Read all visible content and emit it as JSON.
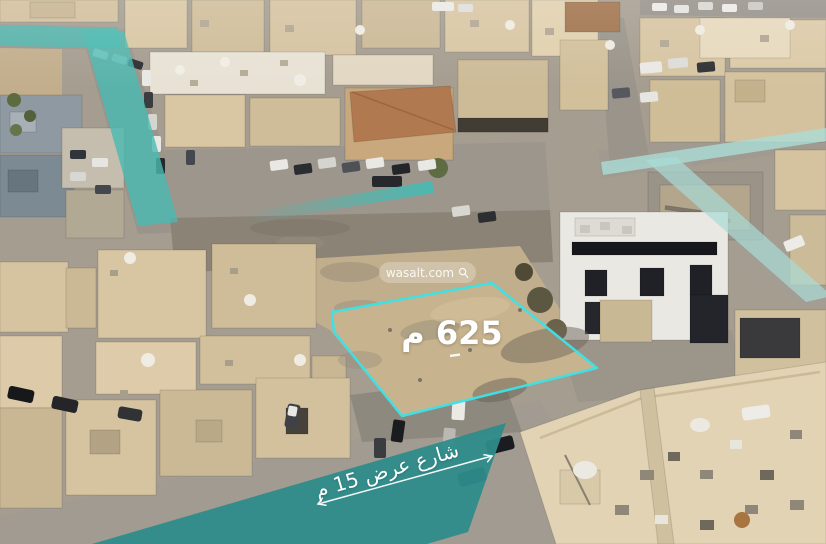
{
  "annotations": {
    "plot_area_label": "625 م",
    "street_banner_label": "شارع عرض 15 م"
  },
  "watermark": {
    "text": "wasalt.com",
    "icon": "location-pin"
  },
  "colors": {
    "plot_outline": "#3ce1e6",
    "road_overlay_teal": "#48bab2",
    "road_overlay_light": "#aadcd6",
    "street_banner_bg": "#2e8c8b",
    "annotation_text": "#ffffff"
  }
}
